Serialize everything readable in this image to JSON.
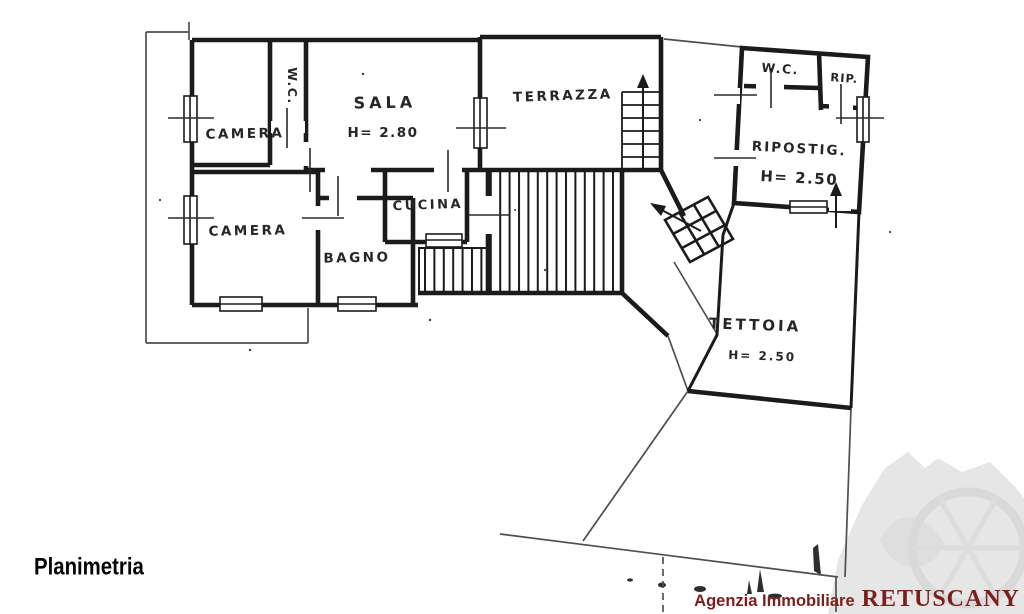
{
  "caption": "Planimetria",
  "agency": {
    "prefix": "Agenzia Immobiliare",
    "name": "RETUSCANY"
  },
  "rooms": {
    "camera_top": "CAMERA",
    "wc_main": "W.C.",
    "sala": "SALA",
    "sala_height": "H= 2.80",
    "terrazza": "TERRAZZA",
    "cucina": "CUCINA",
    "camera_bottom": "CAMERA",
    "bagno": "BAGNO",
    "wc_annex": "W.C.",
    "rip": "RIP.",
    "ripostiglio": "RIPOSTIG.",
    "ripostiglio_height": "H= 2.50",
    "tettoia": "TETTOIA",
    "tettoia_height": "H= 2.50"
  },
  "colors": {
    "ink": "#1b1b1b",
    "boundary": "#4f4f4f",
    "agency_red": "#7c1f1c",
    "watermark_gray": "#e6e6e6"
  }
}
